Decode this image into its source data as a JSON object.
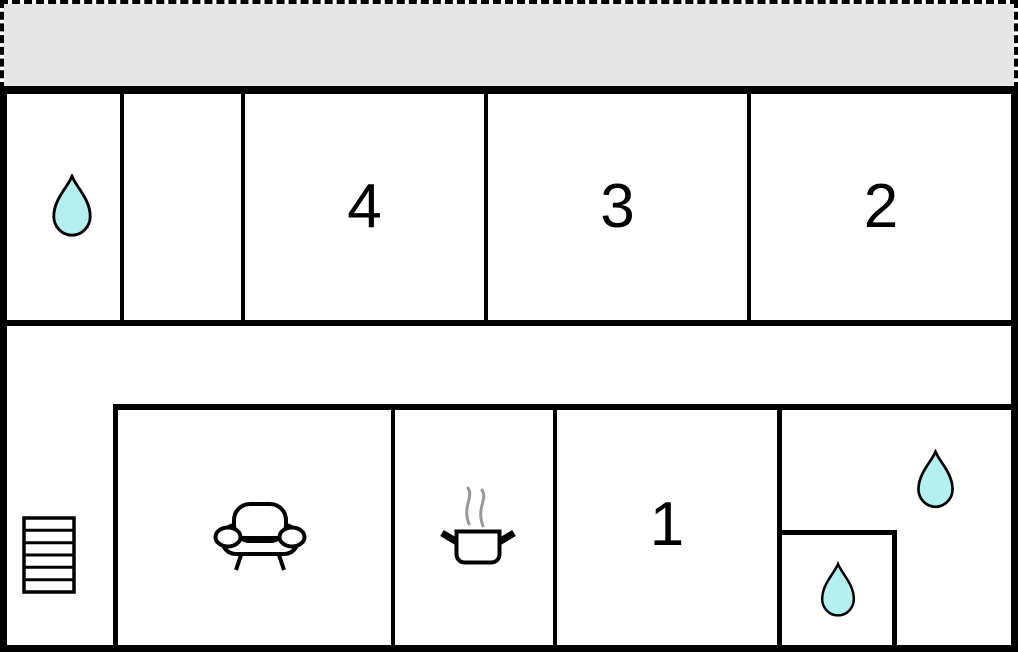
{
  "colors": {
    "wall": "#000000",
    "terrace_fill": "#e6e6e6",
    "water_drop_fill": "#b4f0ef",
    "steam": "#999999",
    "floor": "#ffffff"
  },
  "rooms": {
    "terrace": {
      "name": "terrace"
    },
    "bathroom_upper": {
      "icon": "water-drop"
    },
    "storage": {
      "icon": ""
    },
    "bedroom4": {
      "label": "4"
    },
    "bedroom3": {
      "label": "3"
    },
    "bedroom2": {
      "label": "2"
    },
    "hallway": {
      "icon": "stairs"
    },
    "living_room": {
      "icon": "sofa"
    },
    "kitchen": {
      "icon": "cooking-pot"
    },
    "bedroom1": {
      "label": "1"
    },
    "bathroom_right": {
      "icon": "water-drop"
    },
    "bathroom_inner": {
      "icon": "water-drop"
    }
  }
}
